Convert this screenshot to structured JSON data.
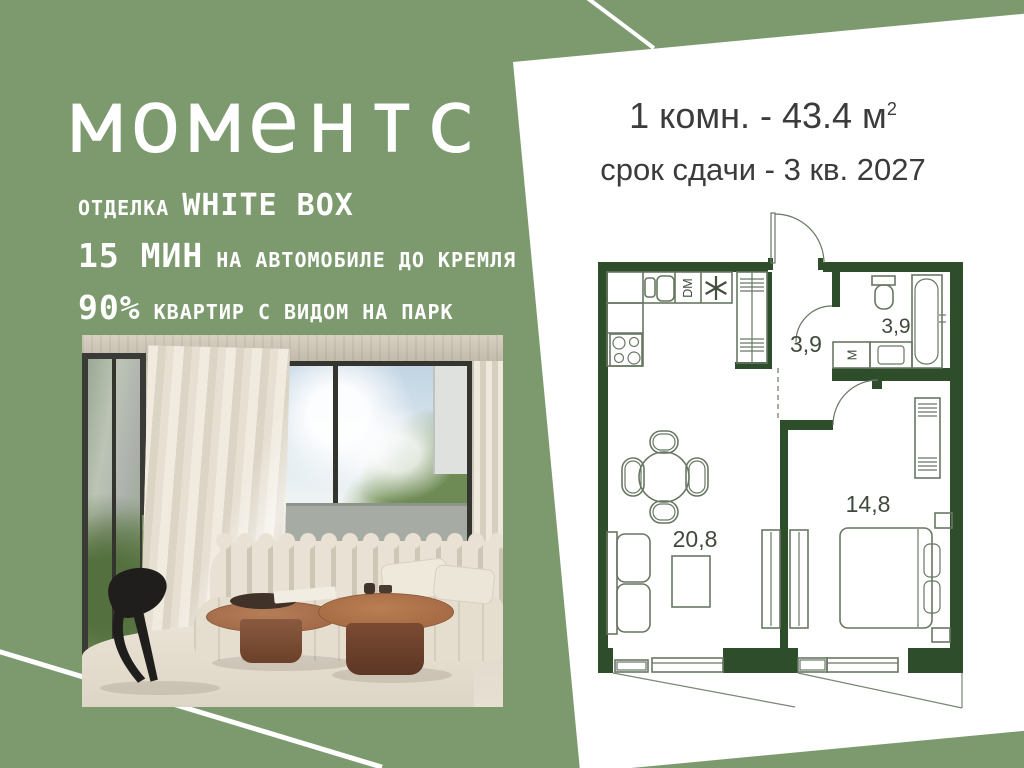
{
  "colors": {
    "background": "#7C9A6E",
    "wall": "#2E4D2B",
    "plan_line": "#687763",
    "panel": "#FFFFFF",
    "text_light": "#FFFFFF",
    "text_dark": "#3B3B3B"
  },
  "brand": {
    "logo": "моментс"
  },
  "left_panel": {
    "finish_label": "ОТДЕЛКА",
    "finish_value": "WHITE BOX",
    "drive_value": "15 МИН",
    "drive_label": "НА АВТОМОБИЛЕ ДО КРЕМЛЯ",
    "view_value": "90%",
    "view_label": "КВАРТИР С ВИДОМ НА ПАРК"
  },
  "offer": {
    "area_line": "1 комн. - 43.4 м",
    "area_sup": "2",
    "deadline_line": "срок сдачи - 3 кв. 2027"
  },
  "floorplan": {
    "living_area": "20,8",
    "bedroom_area": "14,8",
    "hall_area": "3,9",
    "bathroom_area": "3,9",
    "dishwasher": "DM",
    "washer": "M"
  }
}
